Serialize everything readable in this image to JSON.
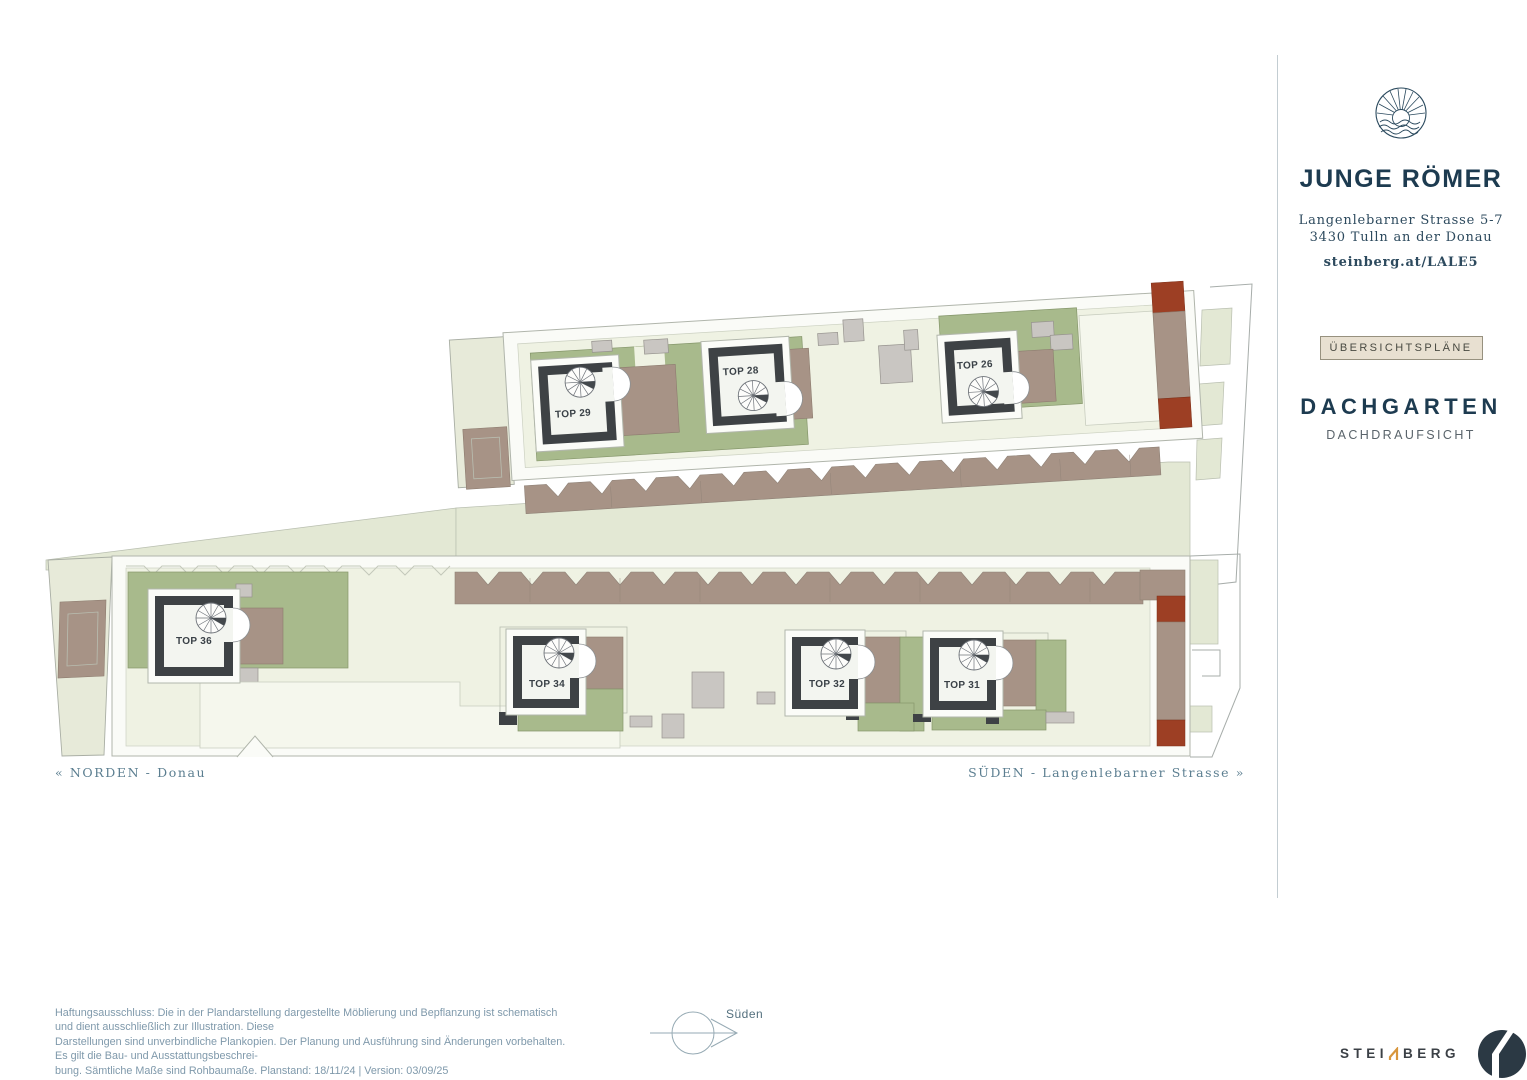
{
  "brand": {
    "name": "JUNGE RÖMER",
    "address_line1": "Langenlebarner Strasse 5-7",
    "address_line2": "3430 Tulln an der Donau",
    "website": "steinberg.at/LALE5"
  },
  "sidebar": {
    "badge": "ÜBERSICHTSPLÄNE",
    "title": "DACHGARTEN",
    "subtitle": "DACHDRAUFSICHT"
  },
  "plan": {
    "units": [
      {
        "label": "TOP 29"
      },
      {
        "label": "TOP 28"
      },
      {
        "label": "TOP 26"
      },
      {
        "label": "TOP 36"
      },
      {
        "label": "TOP 34"
      },
      {
        "label": "TOP 32"
      },
      {
        "label": "TOP 31"
      }
    ],
    "direction_left": "« NORDEN - Donau",
    "direction_right": "SÜDEN - Langenlebarner Strasse »",
    "compass_label": "Süden"
  },
  "footer": {
    "disclaimer_line1": "Haftungsausschluss: Die in der Plandarstellung dargestellte Möblierung und Bepflanzung ist schematisch und dient ausschließlich zur Illustration. Diese",
    "disclaimer_line2": "Darstellungen sind unverbindliche Plankopien. Der Planung und Ausführung sind Änderungen vorbehalten. Es gilt die Bau- und Ausstattungsbeschrei-",
    "disclaimer_line3": "bung. Sämtliche Maße sind Rohbaumaße. Planstand: 18/11/24  |  Version: 03/09/25",
    "logo_text_left": "STEI",
    "logo_text_right": "BERG"
  },
  "colors": {
    "navy": "#1d3b50",
    "garden_green": "#a8ba8c",
    "deck_brown": "#a79386",
    "chimney_red": "#9d3f24",
    "badge_bg": "#e8e0d1",
    "logo_orange": "#d8963c"
  }
}
